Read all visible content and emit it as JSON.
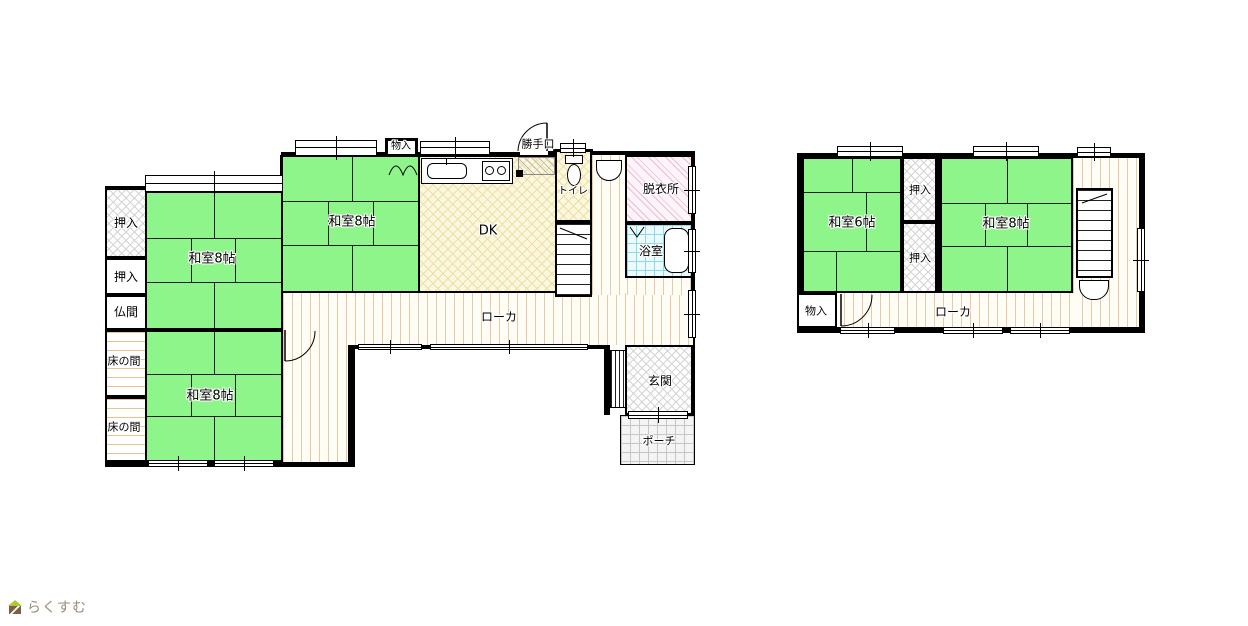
{
  "logo": {
    "text": "らくすむ"
  },
  "floor1": {
    "rooms": {
      "washitsu_nw": "和室8帖",
      "washitsu_sw": "和室8帖",
      "washitsu_n": "和室8帖",
      "oshiire_1": "押入",
      "oshiire_2": "押入",
      "butsuma": "仏間",
      "tokonoma_1": "床の間",
      "tokonoma_2": "床の間",
      "monoire": "物入",
      "dk": "DK",
      "katteguchi": "勝手口",
      "toilet": "トイレ",
      "datsuijo": "脱衣所",
      "yokushitsu": "浴室",
      "roka": "ローカ",
      "genkan": "玄関",
      "porch": "ポーチ"
    }
  },
  "floor2": {
    "rooms": {
      "washitsu_6": "和室6帖",
      "washitsu_8": "和室8帖",
      "oshiire_top": "押入",
      "oshiire_bottom": "押入",
      "monoire": "物入",
      "roka": "ローカ"
    }
  },
  "colors": {
    "tatami_green": "#8df58a",
    "dk_yellow": "#fcf8df",
    "bath_blue": "#ecfafd",
    "dressing_pink": "#eebcd8",
    "corridor_stripe": "#e6cba4",
    "wall": "#000000",
    "logo_text": "#9b8b79"
  }
}
